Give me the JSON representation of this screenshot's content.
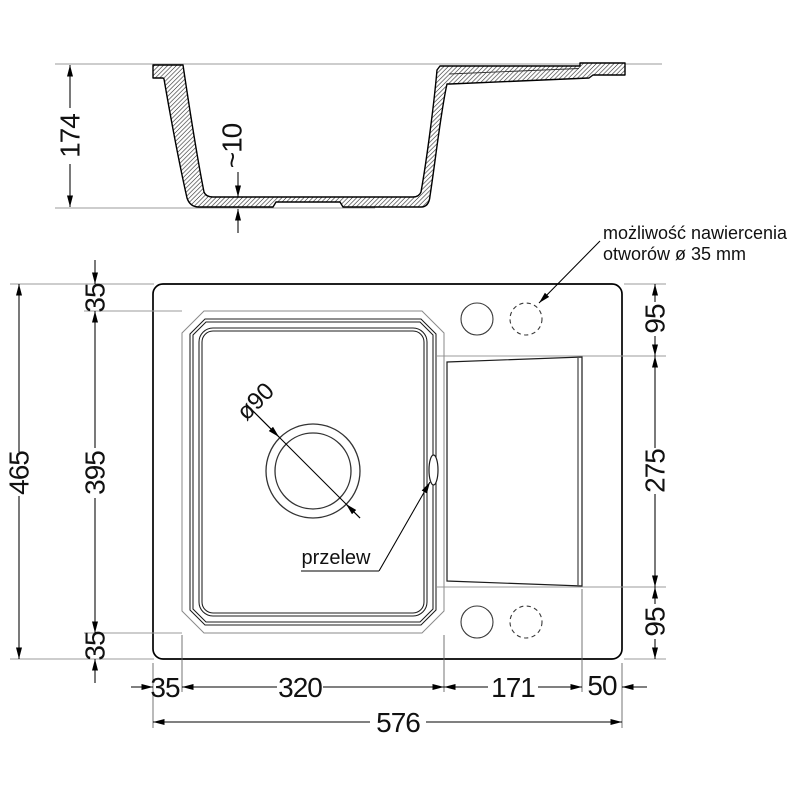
{
  "section": {
    "depth": "174",
    "bottom_thickness": "~10"
  },
  "plan": {
    "left_dims": {
      "overall": "465",
      "top": "35",
      "bowl": "395",
      "bottom": "35"
    },
    "right_dims": {
      "top": "95",
      "drainboard": "275",
      "bottom": "95"
    },
    "bottom_dims": {
      "left": "35",
      "bowl": "320",
      "drainboard": "171",
      "right": "50",
      "overall": "576"
    },
    "drain_diameter": "ø90",
    "overflow": "przelew",
    "note": {
      "line1": "możliwość nawiercenia",
      "line2": "otworów ø 35 mm"
    }
  },
  "colors": {
    "line": "#000000",
    "extension": "#9b9b9b",
    "background": "#ffffff"
  }
}
